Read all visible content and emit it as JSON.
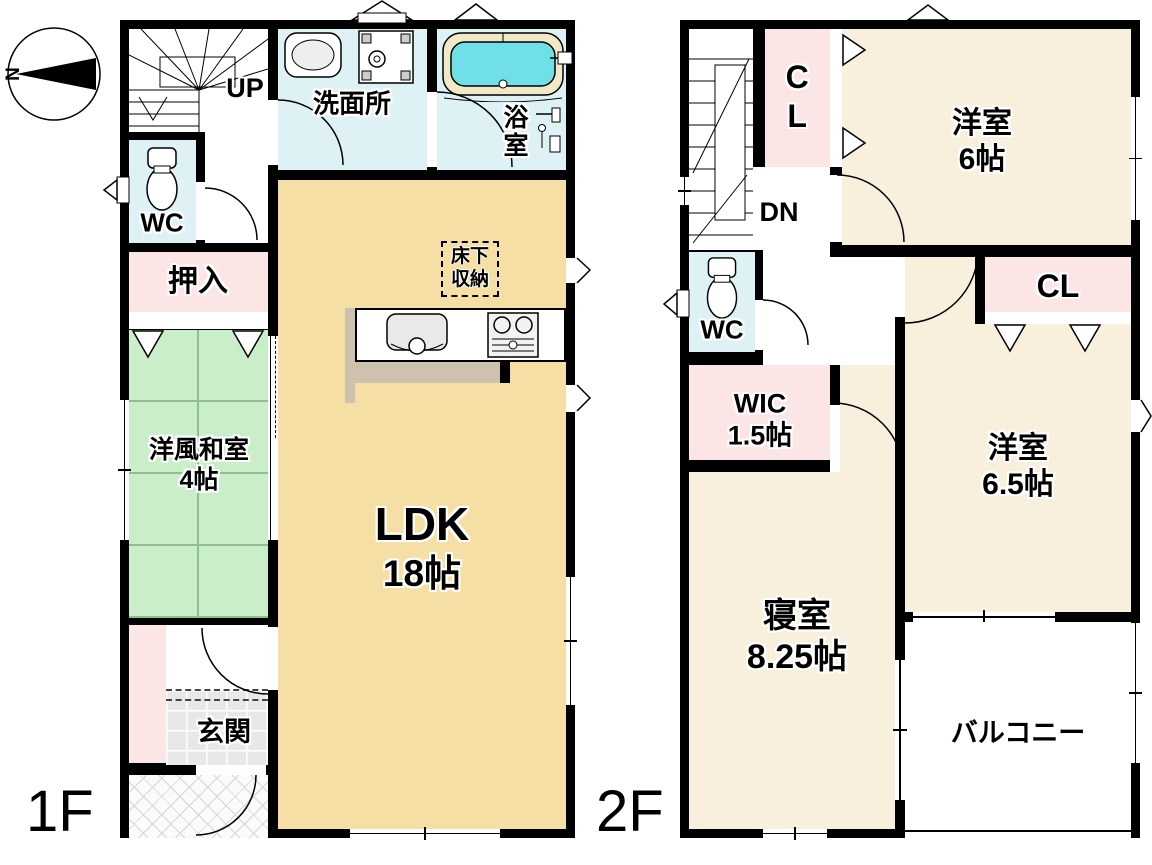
{
  "compass": {
    "north_label": "N"
  },
  "colors": {
    "wall": "#000000",
    "wet": "#def2f6",
    "tatami": "#c9eec9",
    "tatami_line": "#8cc08c",
    "closet": "#fbe5e5",
    "ldk": "#f6dfa4",
    "room2f": "#f8f0dd",
    "tile": "#e8e8e8",
    "tub": "#6fe0e8",
    "tub_rim": "#f0e9c6",
    "counter_shadow": "#ccc2ae"
  },
  "floor1": {
    "title": "1F",
    "stairs_label": "UP",
    "rooms": {
      "wc": {
        "label": "WC"
      },
      "oshiire": {
        "label": "押入"
      },
      "washitsu": {
        "label": "洋風和室",
        "size": "4帖"
      },
      "genkan": {
        "label": "玄関"
      },
      "senmenjo": {
        "label": "洗面所"
      },
      "yokushitsu": {
        "label": "浴室"
      },
      "ldk": {
        "label": "LDK",
        "size": "18帖"
      },
      "yukashita": {
        "line1": "床下",
        "line2": "収納"
      }
    }
  },
  "floor2": {
    "title": "2F",
    "stairs_label": "DN",
    "rooms": {
      "cl_north": {
        "label": "CL"
      },
      "yoshitsu6": {
        "label": "洋室",
        "size": "6帖"
      },
      "wc": {
        "label": "WC"
      },
      "wic": {
        "label": "WIC",
        "size": "1.5帖"
      },
      "cl_east": {
        "label": "CL"
      },
      "yoshitsu65": {
        "label": "洋室",
        "size": "6.5帖"
      },
      "shinshitsu": {
        "label": "寝室",
        "size": "8.25帖"
      },
      "balcony": {
        "label": "バルコニー"
      }
    }
  }
}
